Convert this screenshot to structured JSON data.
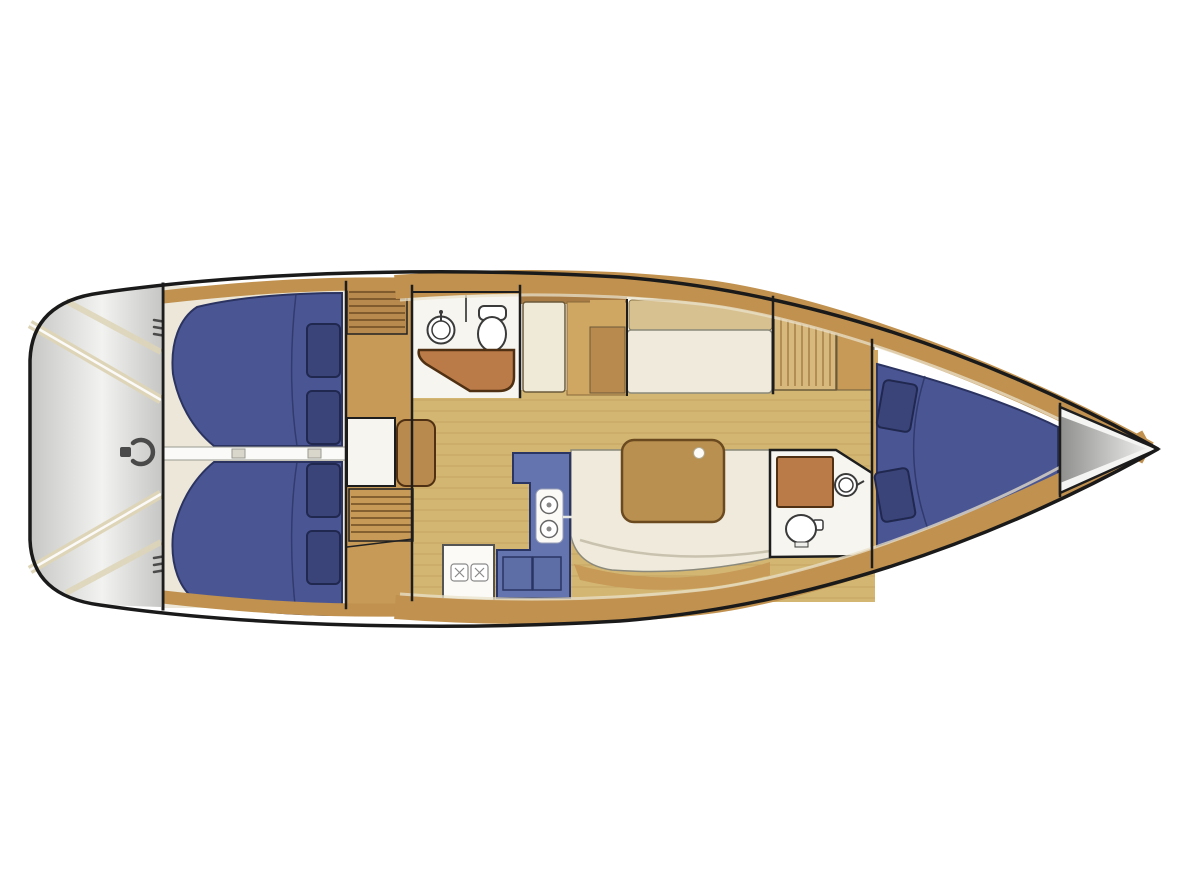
{
  "diagram": {
    "type": "yacht-interior-floor-plan",
    "view": "top-down",
    "bow_direction": "right",
    "stern_direction": "left"
  },
  "features": {
    "cockpit": {
      "name": "cockpit-transom",
      "items": [
        "steering-wheel",
        "bench-edge-stripes",
        "stern-cleats"
      ]
    },
    "aft_cabin_port": {
      "berth": "double",
      "pillows": 2
    },
    "aft_cabin_starboard": {
      "berth": "double",
      "pillows": 2
    },
    "companionway": {
      "step_blocks": 2
    },
    "nav_station": {
      "desk": true,
      "seat": true
    },
    "head_aft": {
      "fixtures": [
        "round-sink",
        "toilet",
        "shower-bench"
      ]
    },
    "galley": {
      "shape": "L",
      "fixtures": [
        "double-sink",
        "two-burner-stove",
        "counter-panels"
      ]
    },
    "saloon": {
      "table_cupholders": 1,
      "settees": [
        "upper-bench-settee",
        "u-shaped-lower-settee"
      ]
    },
    "lockers": [
      "tall-locker",
      "louvered-locker"
    ],
    "head_forward": {
      "fixtures": [
        "vanity-counter",
        "round-sink",
        "toilet"
      ]
    },
    "forward_cabin": {
      "berth": "v-berth",
      "pillows": 2
    },
    "bow": {
      "anchor_locker": true
    }
  },
  "palette": {
    "hull_outline": "#1a1a1a",
    "wall_line": "#1d1d1d",
    "hull_fill": "#ffffff",
    "transom_edge": "#c7c7c5",
    "transom_light": "#f2f2f0",
    "stripe_cream": "#ded5b8",
    "wheel_gray": "#4a4a4a",
    "deck_wood": "#c0914f",
    "wood_mid": "#c79a58",
    "wood_dark": "#a87c44",
    "wood_block": "#b98a4e",
    "wood_light": "#cfa763",
    "cabin_cream": "#ece7d8",
    "floor_tan": "#d3b672",
    "berth_blue": "#4a5694",
    "berth_outline": "#2b3361",
    "pillow_blue": "#3a4479",
    "pillow_outline": "#20284f",
    "galley_blue": "#6474ae",
    "galley_panel": "#5d6da6",
    "galley_outline": "#2a3563",
    "fixture_white": "#fbfaf6",
    "fixture_stroke": "#3a3a3a",
    "seat_cream": "#efeadb",
    "seat_stroke": "#8a897b",
    "backrest_tan": "#d8c191",
    "bench_brown": "#bb7b48",
    "bench_stroke": "#4f3012",
    "table_brown": "#b9904f",
    "table_stroke": "#6b4a20",
    "louver_tan": "#d7b97e",
    "divider_white": "#fafaf8",
    "band_highlight": "#e9e1cb",
    "bow_gray_dark": "#8f8f8d",
    "bow_gray_light": "#ececea"
  }
}
